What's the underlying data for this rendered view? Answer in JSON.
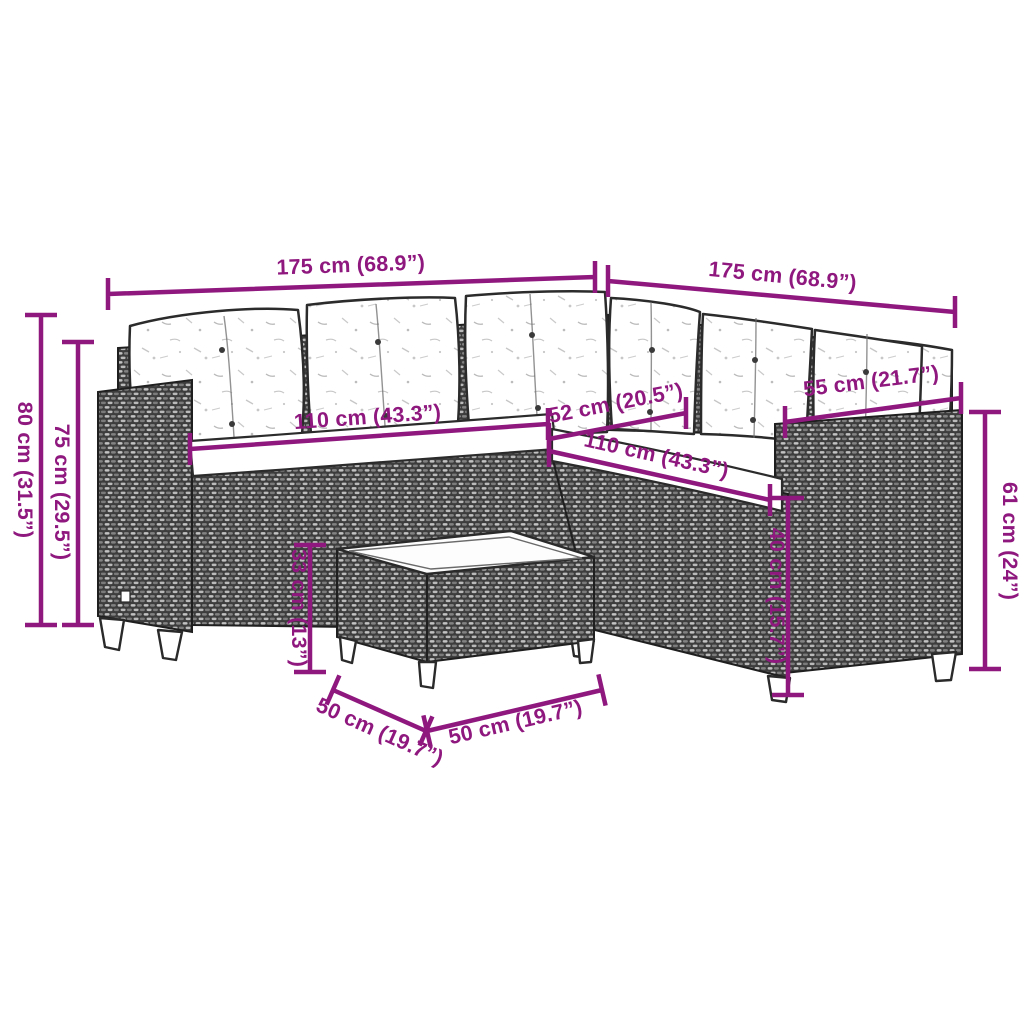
{
  "diagram": {
    "subject": "L-shaped poly rattan garden sofa set with cushions and coffee table - dimension diagram",
    "accent_color": "#8F187F",
    "dimensions": {
      "sofa_width_left": "175 cm (68.9”)",
      "sofa_width_right": "175 cm (68.9”)",
      "total_height": "80 cm (31.5”)",
      "back_height": "75 cm (29.5”)",
      "seat_width_left": "110 cm (43.3”)",
      "corner_seat_depth": "52 cm (20.5”)",
      "seat_width_right": "110 cm (43.3”)",
      "armrest_depth": "55 cm (21.7”)",
      "armrest_height": "61 cm (24”)",
      "seat_height": "40 cm (15.7”)",
      "table_height": "33 cm (13”)",
      "table_depth": "50 cm (19.7”)",
      "table_width": "50 cm (19.7”)"
    }
  }
}
